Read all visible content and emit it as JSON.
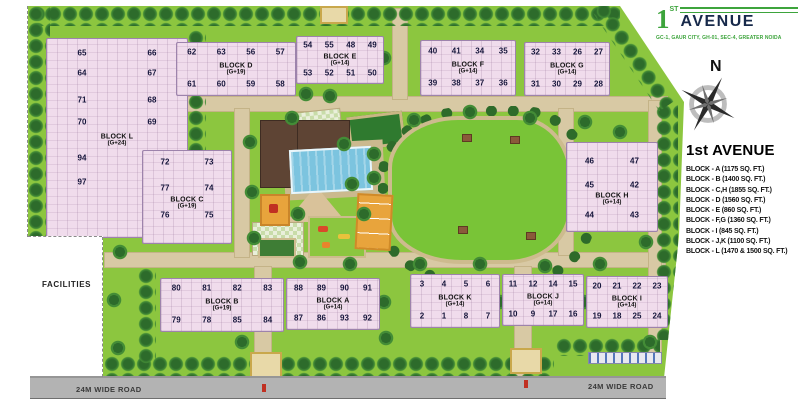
{
  "logo": {
    "numeral": "1",
    "superscript": "ST",
    "brand": "AVENUE",
    "subtitle": "GC-1, GAUR CITY, GH-01, SEC-4, GREATER NOIDA"
  },
  "compass": {
    "north_label": "N"
  },
  "legend": {
    "title": "1st AVENUE",
    "items": [
      "BLOCK - A  (1175 SQ. FT.)",
      "BLOCK - B  (1400 SQ. FT.)",
      "BLOCK - C,H  (1855 SQ. FT.)",
      "BLOCK - D  (1560 SQ. FT.)",
      "BLOCK - E  (860 SQ. FT.)",
      "BLOCK - F,G  (1360 SQ. FT.)",
      "BLOCK - I  (845 SQ. FT.)",
      "BLOCK - J,K  (1100 SQ. FT.)",
      "BLOCK - L  (1470 & 1500 SQ. FT.)"
    ]
  },
  "map_labels": {
    "facilities": "FACILITIES",
    "road_bottom_left": "24M WIDE ROAD",
    "road_bottom_right": "24M WIDE ROAD"
  },
  "colors": {
    "site_green": "#8CC63F",
    "lawn_green": "#79C437",
    "tree_dark": "#2D6B2B",
    "building_pink": "#F0DCEC",
    "building_outline": "#9D83AC",
    "road_tan": "#D8C9A4",
    "outer_road_gray": "#B3B3B3",
    "pool_blue": "#7CC4DF",
    "clubhouse_brown": "#5E4434",
    "play_orange": "#E8A43C",
    "logo_green": "#3DA43C",
    "logo_navy": "#17294A"
  },
  "blocks": [
    {
      "id": "L",
      "name": "BLOCK L",
      "floors": "(G+24)",
      "rect": [
        46,
        38,
        140,
        198
      ],
      "row_fracs": [
        0.07,
        0.17,
        0.31,
        0.42,
        0.6,
        0.72
      ],
      "label_frac": 0.51,
      "rows": [
        [
          "65",
          "66"
        ],
        [
          "64",
          "67"
        ],
        [
          "71",
          "68"
        ],
        [
          "70",
          "69"
        ],
        [
          "94",
          "95"
        ],
        [
          "97",
          "96"
        ]
      ]
    },
    {
      "id": "D",
      "name": "BLOCK D",
      "floors": "(G+19)",
      "rect": [
        176,
        42,
        118,
        52
      ],
      "rows": [
        [
          "62",
          "63",
          "56",
          "57"
        ],
        [
          "61",
          "60",
          "59",
          "58"
        ]
      ]
    },
    {
      "id": "E",
      "name": "BLOCK E",
      "floors": "(G+14)",
      "rect": [
        296,
        36,
        86,
        46
      ],
      "rows": [
        [
          "54",
          "55",
          "48",
          "49"
        ],
        [
          "53",
          "52",
          "51",
          "50"
        ]
      ]
    },
    {
      "id": "F",
      "name": "BLOCK F",
      "floors": "(G+14)",
      "rect": [
        420,
        40,
        94,
        54
      ],
      "rows": [
        [
          "40",
          "41",
          "34",
          "35"
        ],
        [
          "39",
          "38",
          "37",
          "36"
        ]
      ]
    },
    {
      "id": "G",
      "name": "BLOCK G",
      "floors": "(G+14)",
      "rect": [
        524,
        42,
        84,
        52
      ],
      "rows": [
        [
          "32",
          "33",
          "26",
          "27"
        ],
        [
          "31",
          "30",
          "29",
          "28"
        ]
      ]
    },
    {
      "id": "C",
      "name": "BLOCK C",
      "floors": "(G+19)",
      "rect": [
        142,
        150,
        88,
        92
      ],
      "row_fracs": [
        0.12,
        0.4,
        0.7
      ],
      "label_frac": 0.56,
      "rows": [
        [
          "72",
          "73"
        ],
        [
          "77",
          "74"
        ],
        [
          "76",
          "75"
        ]
      ]
    },
    {
      "id": "H",
      "name": "BLOCK H",
      "floors": "(G+14)",
      "rect": [
        566,
        142,
        90,
        88
      ],
      "row_fracs": [
        0.2,
        0.48,
        0.82
      ],
      "label_frac": 0.64,
      "rows": [
        [
          "46",
          "47"
        ],
        [
          "45",
          "42"
        ],
        [
          "44",
          "43"
        ]
      ]
    },
    {
      "id": "B",
      "name": "BLOCK B",
      "floors": "(G+19)",
      "rect": [
        160,
        278,
        122,
        52
      ],
      "rows": [
        [
          "80",
          "81",
          "82",
          "83"
        ],
        [
          "79",
          "78",
          "85",
          "84"
        ]
      ]
    },
    {
      "id": "A",
      "name": "BLOCK A",
      "floors": "(G+14)",
      "rect": [
        286,
        278,
        92,
        50
      ],
      "rows": [
        [
          "88",
          "89",
          "90",
          "91"
        ],
        [
          "87",
          "86",
          "93",
          "92"
        ]
      ]
    },
    {
      "id": "K",
      "name": "BLOCK K",
      "floors": "(G+14)",
      "rect": [
        410,
        274,
        88,
        52
      ],
      "rows": [
        [
          "3",
          "4",
          "5",
          "6"
        ],
        [
          "2",
          "1",
          "8",
          "7"
        ]
      ]
    },
    {
      "id": "J",
      "name": "BLOCK J",
      "floors": "(G+14)",
      "rect": [
        502,
        274,
        80,
        50
      ],
      "rows": [
        [
          "11",
          "12",
          "14",
          "15"
        ],
        [
          "10",
          "9",
          "17",
          "16"
        ]
      ]
    },
    {
      "id": "I",
      "name": "BLOCK I",
      "floors": "(G+14)",
      "rect": [
        586,
        276,
        80,
        50
      ],
      "rows": [
        [
          "20",
          "21",
          "22",
          "23"
        ],
        [
          "19",
          "18",
          "25",
          "24"
        ]
      ]
    }
  ]
}
